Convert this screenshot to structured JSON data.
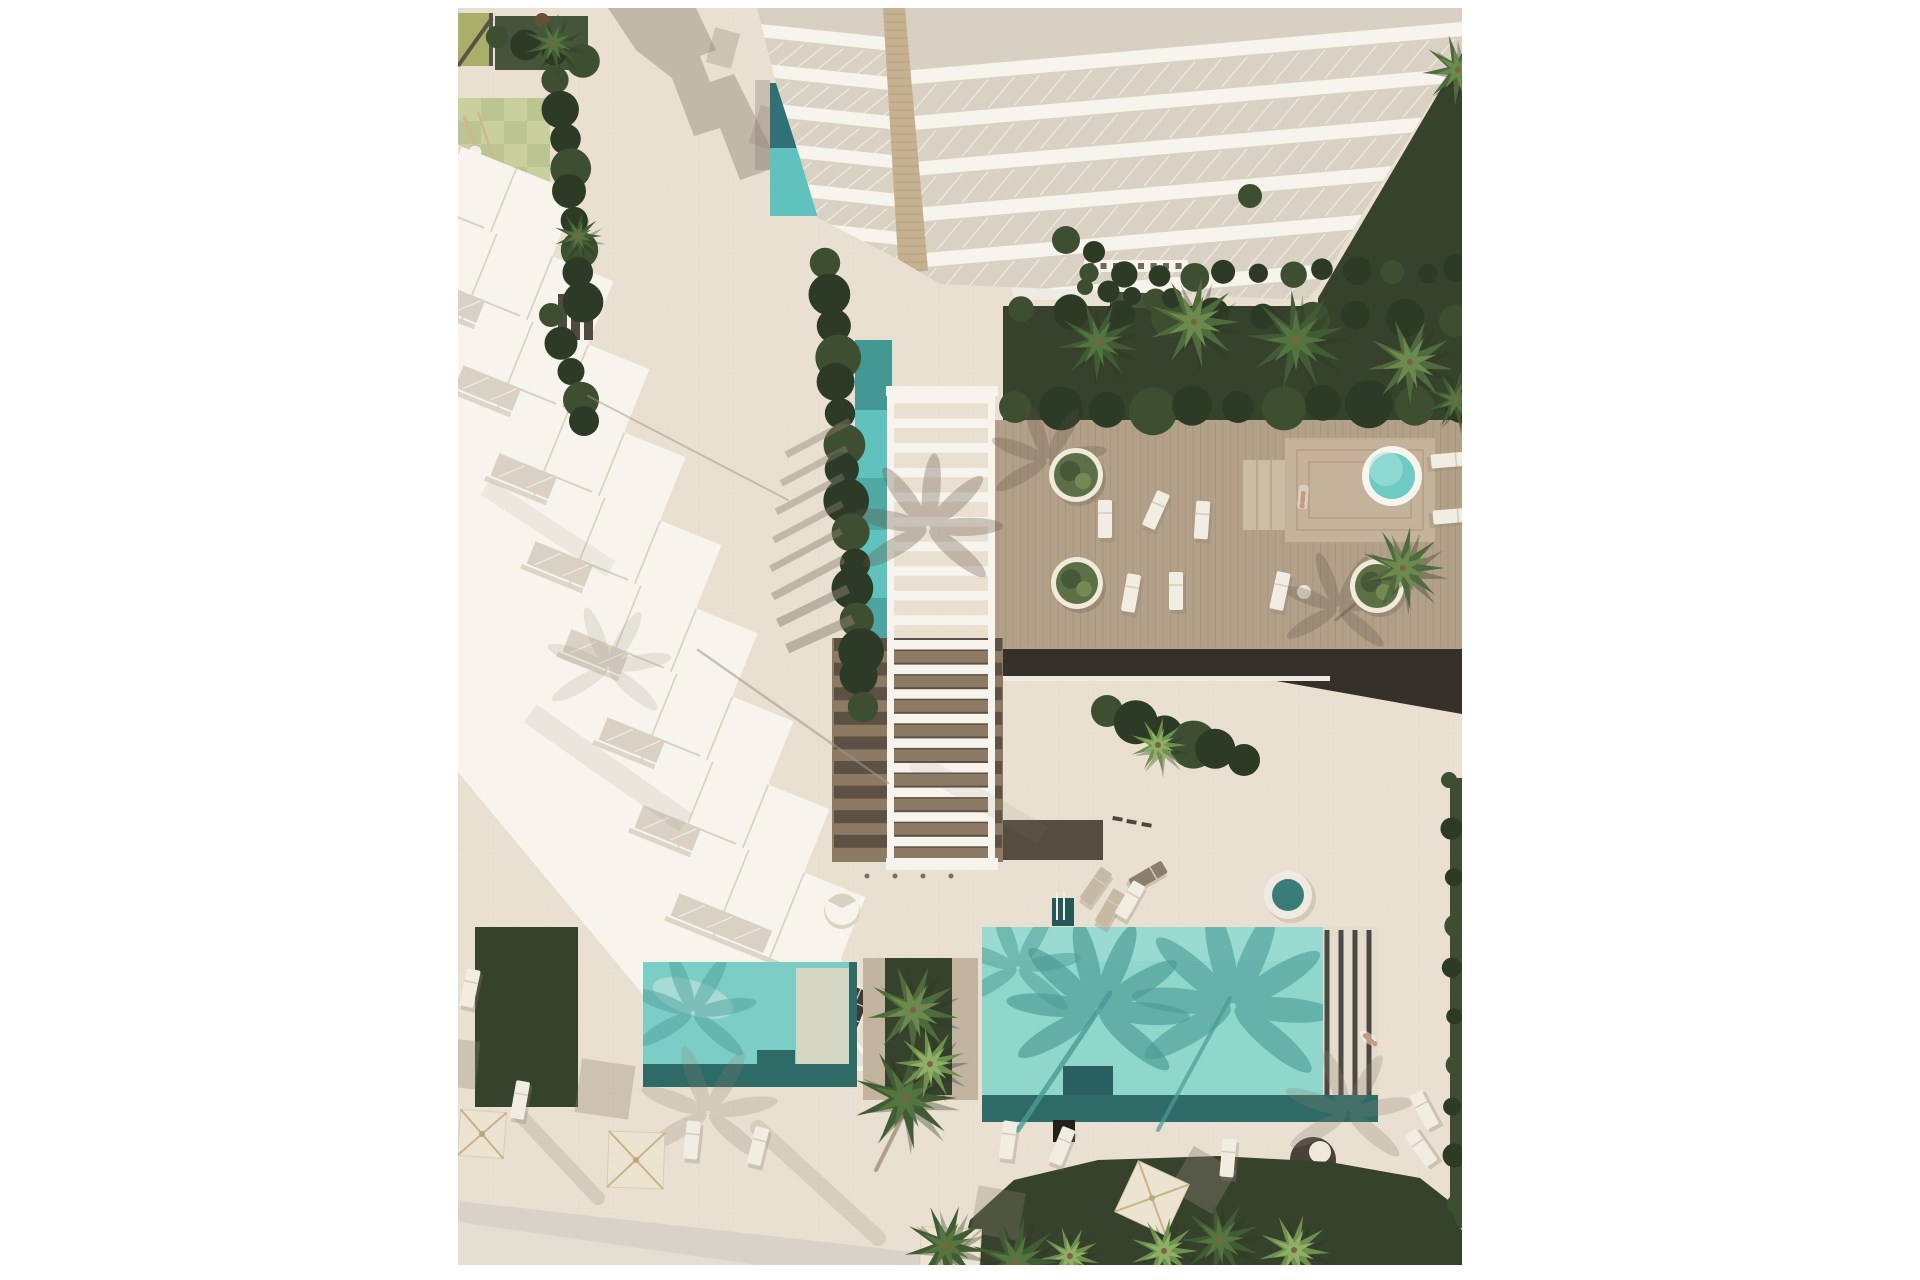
{
  "meta": {
    "description": "Aerial top-down architectural rendering of a resort residential complex with pools, wooden deck, pergola, lawns and palm trees",
    "canvas": {
      "w": 1920,
      "h": 1280
    },
    "image_area": {
      "x": 458,
      "y": 8,
      "w": 1004,
      "h": 1257
    }
  },
  "colors": {
    "bg": "#ffffff",
    "pavement": "#eae0d2",
    "pavement_warm": "#e6dccd",
    "tile_line": "#c9bda9",
    "road": "#d8d2c9",
    "road_light": "#e4ddd2",
    "playground_sage": "#c9cf9d",
    "playground_sage2": "#bcc492",
    "playground_moss": "#75875a",
    "pergola_olive": "#a7af68",
    "frame_dark": "#55534a",
    "grass_dark": "#36422c",
    "grass_mid": "#45543a",
    "hedge_dark": "#2c3a26",
    "hedge_mid": "#3d4f30",
    "palm_dark1": "#415c34",
    "palm_dark2": "#56743f",
    "palm_mid1": "#4f6b3e",
    "palm_mid2": "#6c8a4e",
    "palm_light1": "#6f9150",
    "palm_light2": "#8fae66",
    "deck_wood": "#b2a089",
    "deck_line": "#a08d77",
    "deck_platform": "#c4b29a",
    "deck_steps": "#cdbca4",
    "deck_dark_band": "#35302a",
    "walk_brown": "#8d7a64",
    "walk_brown_dark": "#574c40",
    "white": "#f7f4ed",
    "white_soft": "#efebe2",
    "slab_shadow": "#d7d0c3",
    "glass": "#d9d2c4",
    "glass_line": "#efece4",
    "spine_tan": "#c5b08f",
    "spine_line": "#b29d7e",
    "olive_box": "#6f6a58",
    "olive_box_dark": "#5d5949",
    "window_dark": "#3e3a32",
    "window_mullion": "#cfc8bb",
    "teal_light": "#8fd6cb",
    "teal_top": "#9cdcd2",
    "teal_mid": "#7ccdc5",
    "teal_shadow": "#4a9b95",
    "teal_dark": "#2e6b66",
    "teal_deep": "#24585b",
    "lap_dark": "#2f7176",
    "lap_light": "#5fc2bd",
    "spa_teal": "#6fcac4",
    "shelf_pale": "#d5d6c4",
    "umbrella": "#ece3d0",
    "umbrella_rib": "#c7b48b",
    "lounger": "#f2ede3",
    "lounger_tan": "#c7b9a4",
    "lounger_dark": "#8a7f6c",
    "daybed_dark": "#4a4238",
    "shadow_gray": "#8b8173",
    "shadow_soft": "#a3968a",
    "deck_feather": "#5f5243",
    "trunk_brown": "#8a7458",
    "person_skin": "#c99a79",
    "stripe_dark": "#4b4a42"
  },
  "scene": {
    "checker": {
      "x": 0,
      "y": 90,
      "cols": 4,
      "rows": 9,
      "s": 23
    },
    "benches": {
      "x0": 100,
      "y": 286,
      "n": 3,
      "dx": 13,
      "w": 9,
      "h": 46
    },
    "pergola": {
      "x": 429,
      "w": 108,
      "rail_w": 7,
      "y0": 378,
      "y1": 862,
      "rungs": 19,
      "rung_h": 9.5,
      "step": 24.6
    },
    "deck_planks": {
      "x0": 540,
      "x1": 1000,
      "step": 7.5,
      "y0": 414,
      "y1": 639
    },
    "townhouses": {
      "n": 9,
      "x0": 78,
      "y0": 272,
      "dx": 36,
      "dy": 88,
      "rot": 22
    },
    "tower_bands": {
      "left": [
        [
          302,
          16
        ],
        [
          308,
          56
        ],
        [
          318,
          96
        ],
        [
          330,
          136
        ],
        [
          346,
          176
        ],
        [
          366,
          216
        ]
      ],
      "right_y": [
        14,
        60,
        106,
        152,
        198,
        244
      ],
      "right_x": 448
    },
    "umbrellas": [
      {
        "x": 24,
        "y": 1126,
        "s": 46,
        "rot": 4
      },
      {
        "x": 178,
        "y": 1152,
        "s": 56,
        "rot": 2
      },
      {
        "x": 694,
        "y": 1190,
        "s": 56,
        "rot": 25
      },
      {
        "x": 492,
        "y": 1250,
        "s": 60,
        "rot": 3
      }
    ],
    "umbrella_shadows": [
      {
        "x": 147,
        "y": 1081,
        "s": 54,
        "rot": 8,
        "op": 0.32
      },
      {
        "x": -4,
        "y": 1055,
        "s": 48,
        "rot": 6,
        "op": 0.3
      },
      {
        "x": 745,
        "y": 1172,
        "s": 50,
        "rot": 30,
        "op": 0.38
      },
      {
        "x": 540,
        "y": 1205,
        "s": 48,
        "rot": 10,
        "op": 0.3
      }
    ],
    "planters": [
      {
        "x": 618,
        "y": 467,
        "r": 27
      },
      {
        "x": 619,
        "y": 575,
        "r": 26
      },
      {
        "x": 919,
        "y": 578,
        "r": 27
      }
    ],
    "loungers": [
      {
        "x": 647,
        "y": 511,
        "rot": 0
      },
      {
        "x": 698,
        "y": 502,
        "rot": 24
      },
      {
        "x": 673,
        "y": 585,
        "rot": 10
      },
      {
        "x": 718,
        "y": 583,
        "rot": 0
      },
      {
        "x": 744,
        "y": 512,
        "rot": 4
      },
      {
        "x": 822,
        "y": 583,
        "rot": 12
      },
      {
        "x": 992,
        "y": 452,
        "rot": 85
      },
      {
        "x": 994,
        "y": 508,
        "rot": 85
      },
      {
        "x": 966,
        "y": 1102,
        "rot": -28
      },
      {
        "x": 963,
        "y": 1140,
        "rot": -35
      },
      {
        "x": 550,
        "y": 1132,
        "rot": 8
      },
      {
        "x": 604,
        "y": 1138,
        "rot": 22
      },
      {
        "x": 770,
        "y": 1150,
        "rot": 5
      },
      {
        "x": 12,
        "y": 980,
        "rot": 12
      },
      {
        "x": 62,
        "y": 1092,
        "rot": 10
      },
      {
        "x": 234,
        "y": 1132,
        "rot": 6
      },
      {
        "x": 300,
        "y": 1138,
        "rot": 14
      },
      {
        "x": 638,
        "y": 878,
        "rot": 35,
        "tone": "tan"
      },
      {
        "x": 652,
        "y": 900,
        "rot": 30,
        "tone": "tan"
      },
      {
        "x": 690,
        "y": 868,
        "rot": 60,
        "tone": "dark"
      },
      {
        "x": 672,
        "y": 892,
        "rot": 30
      }
    ],
    "palms": [
      {
        "x": 455,
        "y": 1002,
        "r": 46,
        "tone": "mid",
        "rot": 10
      },
      {
        "x": 447,
        "y": 1090,
        "r": 52,
        "tone": "dark",
        "rot": 0
      },
      {
        "x": 472,
        "y": 1056,
        "r": 36,
        "tone": "light",
        "rot": 22
      },
      {
        "x": 488,
        "y": 1238,
        "r": 42,
        "tone": "dark",
        "rot": 8
      },
      {
        "x": 558,
        "y": 1254,
        "r": 46,
        "tone": "dark",
        "rot": 0
      },
      {
        "x": 612,
        "y": 1248,
        "r": 30,
        "tone": "light",
        "rot": 14
      },
      {
        "x": 706,
        "y": 1243,
        "r": 34,
        "tone": "light",
        "rot": 0
      },
      {
        "x": 762,
        "y": 1232,
        "r": 40,
        "tone": "dark",
        "rot": 20
      },
      {
        "x": 836,
        "y": 1242,
        "r": 36,
        "tone": "light",
        "rot": 5
      },
      {
        "x": 640,
        "y": 334,
        "r": 40,
        "tone": "dark",
        "rot": 12
      },
      {
        "x": 736,
        "y": 314,
        "r": 46,
        "tone": "mid",
        "rot": 0
      },
      {
        "x": 838,
        "y": 332,
        "r": 50,
        "tone": "dark",
        "rot": 25
      },
      {
        "x": 952,
        "y": 354,
        "r": 44,
        "tone": "mid",
        "rot": 10
      },
      {
        "x": 998,
        "y": 392,
        "r": 30,
        "tone": "dark",
        "rot": 0
      },
      {
        "x": 1000,
        "y": 62,
        "r": 36,
        "tone": "mid",
        "rot": 15
      },
      {
        "x": 945,
        "y": 560,
        "r": 42,
        "tone": "mid",
        "rot": 0
      },
      {
        "x": 120,
        "y": 228,
        "r": 24,
        "tone": "dark",
        "rot": 0
      },
      {
        "x": 95,
        "y": 35,
        "r": 30,
        "tone": "dark",
        "rot": 0
      },
      {
        "x": 700,
        "y": 737,
        "r": 28,
        "tone": "light",
        "rot": 0
      }
    ],
    "hedges": [
      {
        "x1": 100,
        "y1": 75,
        "x2": 126,
        "y2": 295,
        "n": 9,
        "r": 17
      },
      {
        "x1": 96,
        "y1": 310,
        "x2": 128,
        "y2": 415,
        "n": 5,
        "r": 15
      },
      {
        "x1": 370,
        "y1": 258,
        "x2": 406,
        "y2": 700,
        "n": 16,
        "r": 19
      },
      {
        "x1": 634,
        "y1": 268,
        "x2": 1000,
        "y2": 262,
        "n": 12,
        "r": 12
      },
      {
        "x1": 566,
        "y1": 304,
        "x2": 996,
        "y2": 312,
        "n": 10,
        "r": 16
      },
      {
        "x1": 560,
        "y1": 402,
        "x2": 1000,
        "y2": 396,
        "n": 11,
        "r": 20
      },
      {
        "x1": 652,
        "y1": 706,
        "x2": 786,
        "y2": 752,
        "n": 6,
        "r": 20
      },
      {
        "x1": 994,
        "y1": 775,
        "x2": 998,
        "y2": 1195,
        "n": 10,
        "r": 10
      },
      {
        "x1": 42,
        "y1": 32,
        "x2": 122,
        "y2": 50,
        "n": 4,
        "r": 14
      },
      {
        "x1": 630,
        "y1": 282,
        "x2": 716,
        "y2": 292,
        "n": 5,
        "r": 10
      }
    ],
    "feathers": [
      {
        "x": 640,
        "y": 1002,
        "r": 86,
        "n": 8,
        "c": "teal_shadow",
        "op": 0.65,
        "clip": "big"
      },
      {
        "x": 775,
        "y": 998,
        "r": 95,
        "n": 8,
        "c": "teal_shadow",
        "op": 0.6,
        "clip": "big"
      },
      {
        "x": 560,
        "y": 960,
        "r": 60,
        "n": 6,
        "c": "teal_shadow",
        "op": 0.5,
        "clip": "big"
      },
      {
        "x": 235,
        "y": 1005,
        "r": 60,
        "n": 6,
        "c": "teal_shadow",
        "op": 0.45,
        "clip": "left"
      },
      {
        "x": 470,
        "y": 520,
        "r": 70,
        "n": 7,
        "c": "deck_feather",
        "op": 0.3
      },
      {
        "x": 590,
        "y": 452,
        "r": 56,
        "n": 6,
        "c": "deck_feather",
        "op": 0.25
      },
      {
        "x": 880,
        "y": 600,
        "r": 55,
        "n": 6,
        "c": "deck_feather",
        "op": 0.25
      },
      {
        "x": 890,
        "y": 1105,
        "r": 62,
        "n": 6,
        "c": "shadow_gray",
        "op": 0.25
      },
      {
        "x": 250,
        "y": 1105,
        "r": 66,
        "n": 6,
        "c": "shadow_gray",
        "op": 0.22
      },
      {
        "x": 150,
        "y": 660,
        "r": 60,
        "n": 6,
        "c": "shadow_gray",
        "op": 0.15
      }
    ],
    "trunks": [
      {
        "x1": 560,
        "y1": 1122,
        "x2": 652,
        "y2": 985,
        "w": 5,
        "c": "teal_shadow",
        "op": 0.8
      },
      {
        "x1": 700,
        "y1": 1122,
        "x2": 772,
        "y2": 990,
        "w": 4,
        "c": "teal_shadow",
        "op": 0.7
      },
      {
        "x1": 418,
        "y1": 1162,
        "x2": 468,
        "y2": 1062,
        "w": 4,
        "c": "trunk_brown",
        "op": 0.6
      },
      {
        "x1": 240,
        "y1": 642,
        "x2": 430,
        "y2": 775,
        "w": 2.5,
        "c": "shadow_soft",
        "op": 0.55
      },
      {
        "x1": 130,
        "y1": 388,
        "x2": 330,
        "y2": 492,
        "w": 2,
        "c": "shadow_soft",
        "op": 0.5
      },
      {
        "x1": 878,
        "y1": 612,
        "x2": 940,
        "y2": 560,
        "w": 3,
        "c": "deck_feather",
        "op": 0.4
      },
      {
        "x1": 60,
        "y1": 1105,
        "x2": 140,
        "y2": 1190,
        "w": 14,
        "c": "shadow_gray",
        "op": 0.2
      },
      {
        "x1": 300,
        "y1": 1120,
        "x2": 420,
        "y2": 1230,
        "w": 16,
        "c": "shadow_gray",
        "op": 0.18
      }
    ],
    "shadow_bars": [
      {
        "x": 360,
        "y": 430,
        "w": 72,
        "h": 7,
        "rot": -28,
        "op": 0.4
      },
      {
        "x": 356,
        "y": 458,
        "w": 74,
        "h": 7,
        "rot": -28,
        "op": 0.4
      },
      {
        "x": 352,
        "y": 486,
        "w": 76,
        "h": 7,
        "rot": -28,
        "op": 0.42
      },
      {
        "x": 350,
        "y": 514,
        "w": 78,
        "h": 7,
        "rot": -28,
        "op": 0.42
      },
      {
        "x": 348,
        "y": 542,
        "w": 80,
        "h": 7,
        "rot": -28,
        "op": 0.45
      },
      {
        "x": 350,
        "y": 570,
        "w": 80,
        "h": 8,
        "rot": -28,
        "op": 0.45
      },
      {
        "x": 355,
        "y": 598,
        "w": 78,
        "h": 9,
        "rot": -26,
        "op": 0.5
      },
      {
        "x": 362,
        "y": 626,
        "w": 72,
        "h": 10,
        "rot": -24,
        "op": 0.5
      },
      {
        "x": 150,
        "y": 760,
        "w": 190,
        "h": 22,
        "rot": 35,
        "op": 0.12
      },
      {
        "x": 90,
        "y": 520,
        "w": 150,
        "h": 18,
        "rot": 33,
        "op": 0.1
      },
      {
        "x": 520,
        "y": 790,
        "w": 150,
        "h": 20,
        "rot": 30,
        "op": 0.1
      }
    ],
    "dashes": [
      {
        "x": 655,
        "y": 808
      },
      {
        "x": 669,
        "y": 811
      },
      {
        "x": 684,
        "y": 814
      }
    ],
    "people": [
      {
        "x": 910,
        "y": 1030,
        "rot": 40,
        "type": "swimmer"
      },
      {
        "x": 845,
        "y": 489,
        "rot": 95,
        "type": "sunbather"
      }
    ]
  }
}
